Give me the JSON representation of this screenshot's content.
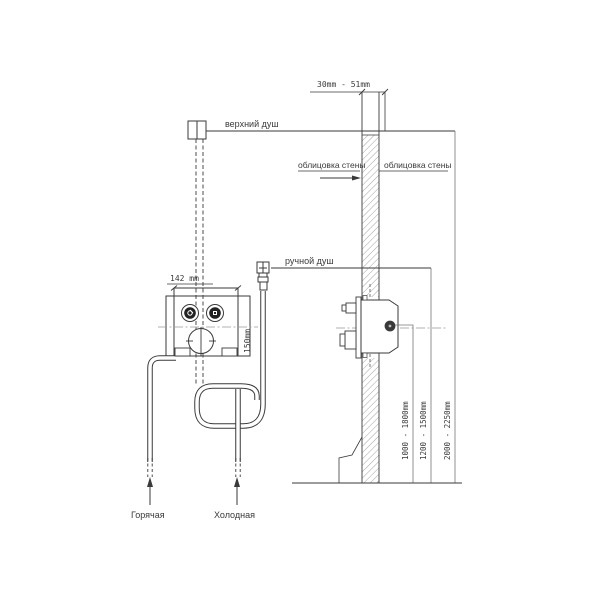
{
  "drawing": {
    "front_view": {
      "upper_shower_label": "верхний душ",
      "hand_shower_label": "ручной душ",
      "valve_width_label": "142 mm",
      "valve_height_label": "150mm",
      "hot_supply_label": "Горячая",
      "cold_supply_label": "Холодная"
    },
    "side_view": {
      "wall_thickness_label": "30mm - 51mm",
      "wall_cladding_left_label": "облицовка стены",
      "wall_cladding_right_label": "облицовка стены",
      "hand_shower_height_label": "1000 - 1800mm",
      "mixer_height_label": "1200 - 1500mm",
      "upper_shower_height_label": "2000 - 2250mm"
    },
    "colors": {
      "line": "#3a3a3a",
      "centerline": "#999999",
      "background": "#ffffff"
    }
  }
}
